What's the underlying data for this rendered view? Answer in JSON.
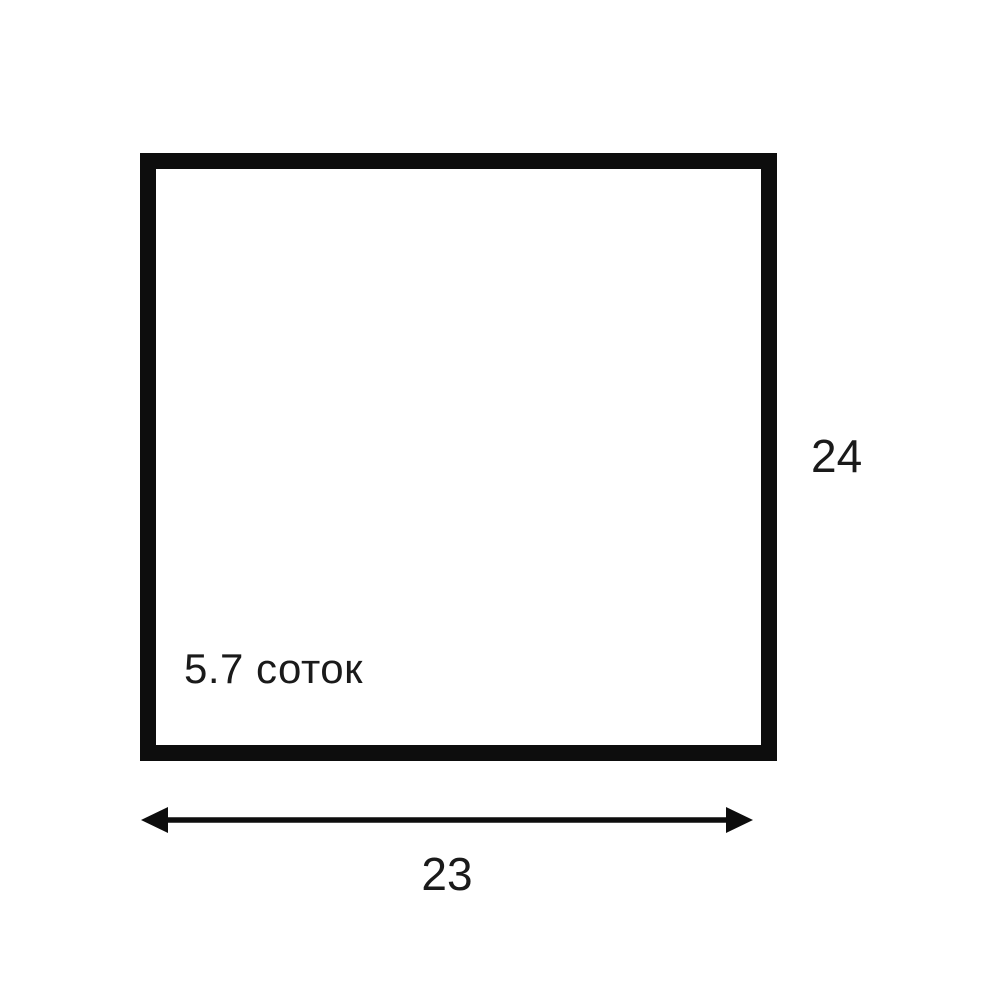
{
  "diagram": {
    "type": "land-plot-dimension-diagram",
    "plot": {
      "area_label": "5.7 соток",
      "width_label": "23",
      "height_label": "24"
    },
    "colors": {
      "outline": "#0d0d0d",
      "text": "#1a1a1a",
      "background": "#ffffff"
    }
  }
}
